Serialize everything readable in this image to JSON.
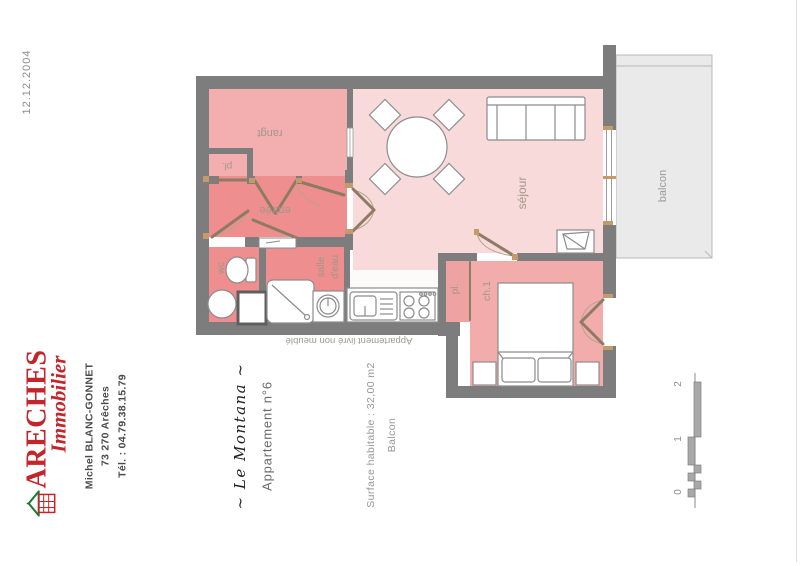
{
  "meta": {
    "date": "12.12.2004"
  },
  "agency": {
    "name_line1": "ARECHES",
    "name_line2": "Immobilier",
    "contact_name": "Michel BLANC-GONNET",
    "address": "73 270 Arêches",
    "phone": "Tél. : 04.79.38.15.79",
    "brand_color": "#c4252a"
  },
  "property": {
    "residence": "~ Le Montana ~",
    "apartment": "Appartement n°6",
    "surface": "Surface habitable : 32,00 m2",
    "surface_extra": "Balcon",
    "note": "Appartement livré non meublé"
  },
  "plan": {
    "labels": {
      "rangt": "rangt",
      "pl1": "pl.",
      "entree": "entrée",
      "wc": "wc",
      "salle": "salle",
      "deau": "d'eau",
      "pl2": "pl.",
      "ch1": "ch.1",
      "sejour": "séjour",
      "balcon": "balcon"
    },
    "colors": {
      "wall": "#7d7d7d",
      "room_dark_pink": "#ee8e8e",
      "room_medium_pink": "#f3afaf",
      "room_light_pink": "#f9dada",
      "balcony_gray": "#eaeaeb",
      "door_leaf": "#8d7b66",
      "cap_tan": "#c49a6a"
    },
    "scale_labels": {
      "s0": "0",
      "s1": "1",
      "s2": "2"
    }
  }
}
